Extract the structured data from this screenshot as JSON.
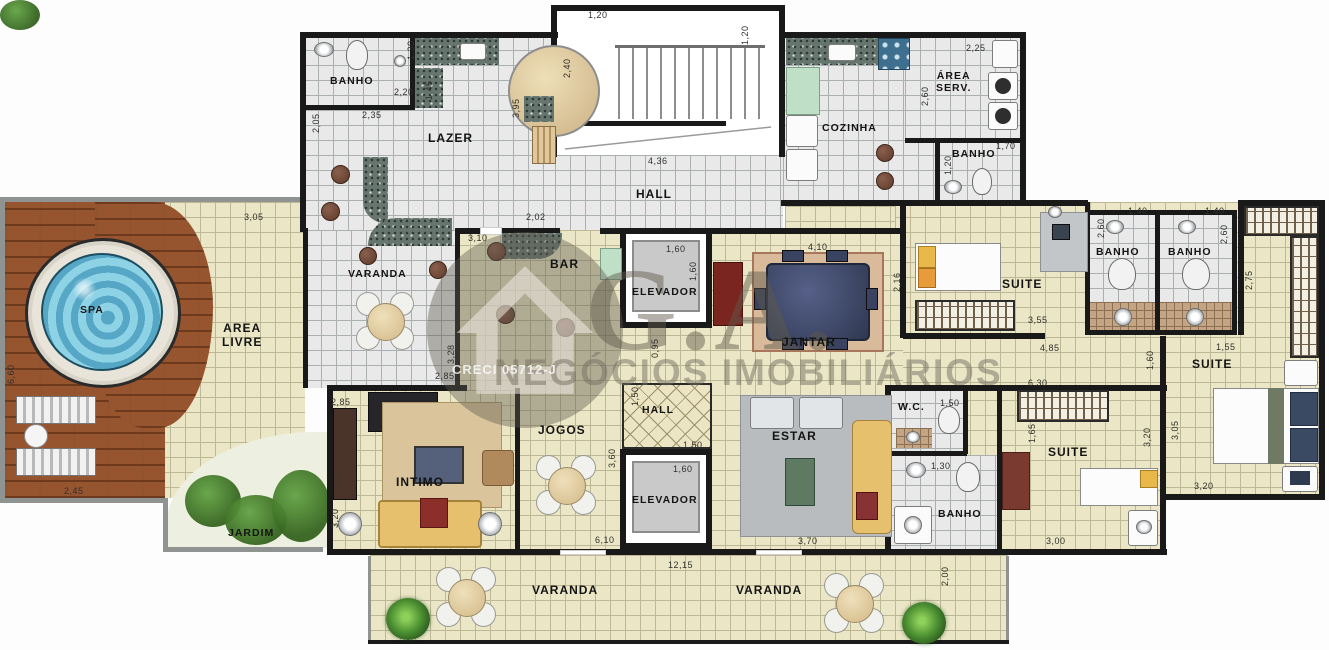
{
  "plan": {
    "title": "Planta baixa - pavimento",
    "watermark": {
      "brand": "G.A.",
      "subtitle": "NEGÓCIOS IMOBILIÁRIOS",
      "license": "CRECI 05712-J"
    },
    "colors": {
      "wall": "#191919",
      "floor_beige": "#ebe7c6",
      "floor_gray": "#e9e9e9",
      "deck_wood": "#96542f",
      "spa_water": "#72bdd8",
      "garden_green": "#3f7a33",
      "granite": "#66756e"
    },
    "room_labels": [
      {
        "id": "banho-lazer",
        "text": "BANHO",
        "x": 330,
        "y": 75,
        "small": true
      },
      {
        "id": "lazer",
        "text": "LAZER",
        "x": 428,
        "y": 132
      },
      {
        "id": "hall-top",
        "text": "HALL",
        "x": 636,
        "y": 188
      },
      {
        "id": "cozinha",
        "text": "COZINHA",
        "x": 822,
        "y": 122,
        "small": true
      },
      {
        "id": "area-serv",
        "text": "ÁREA\nSERV.",
        "x": 936,
        "y": 70,
        "small": true
      },
      {
        "id": "banho-serv",
        "text": "BANHO",
        "x": 952,
        "y": 148,
        "small": true
      },
      {
        "id": "varanda-mid",
        "text": "VARANDA",
        "x": 348,
        "y": 268,
        "small": true
      },
      {
        "id": "bar",
        "text": "BAR",
        "x": 550,
        "y": 258
      },
      {
        "id": "elevador-1",
        "text": "ELEVADOR",
        "x": 632,
        "y": 286,
        "small": true
      },
      {
        "id": "jantar",
        "text": "JANTAR",
        "x": 782,
        "y": 336
      },
      {
        "id": "suite-1",
        "text": "SUITE",
        "x": 1002,
        "y": 278
      },
      {
        "id": "banho-a",
        "text": "BANHO",
        "x": 1096,
        "y": 246,
        "small": true
      },
      {
        "id": "banho-b",
        "text": "BANHO",
        "x": 1168,
        "y": 246,
        "small": true
      },
      {
        "id": "area-livre",
        "text": "AREA\nLIVRE",
        "x": 222,
        "y": 322
      },
      {
        "id": "spa",
        "text": "SPA",
        "x": 80,
        "y": 304,
        "small": true
      },
      {
        "id": "intimo",
        "text": "INTIMO",
        "x": 396,
        "y": 476
      },
      {
        "id": "jogos",
        "text": "JOGOS",
        "x": 538,
        "y": 424
      },
      {
        "id": "hall-small",
        "text": "HALL",
        "x": 642,
        "y": 404,
        "small": true
      },
      {
        "id": "elevador-2",
        "text": "ELEVADOR",
        "x": 632,
        "y": 494,
        "small": true
      },
      {
        "id": "estar",
        "text": "ESTAR",
        "x": 772,
        "y": 430
      },
      {
        "id": "wc",
        "text": "W.C.",
        "x": 898,
        "y": 401,
        "small": true
      },
      {
        "id": "banho-3",
        "text": "BANHO",
        "x": 938,
        "y": 508,
        "small": true
      },
      {
        "id": "suite-3",
        "text": "SUITE",
        "x": 1048,
        "y": 446
      },
      {
        "id": "suite-2",
        "text": "SUITE",
        "x": 1192,
        "y": 358
      },
      {
        "id": "jardim",
        "text": "JARDIM",
        "x": 228,
        "y": 527,
        "small": true
      },
      {
        "id": "varanda-b1",
        "text": "VARANDA",
        "x": 532,
        "y": 584
      },
      {
        "id": "varanda-b2",
        "text": "VARANDA",
        "x": 736,
        "y": 584
      }
    ],
    "dim_labels": [
      {
        "text": "1,20",
        "x": 588,
        "y": 10
      },
      {
        "text": "1,20",
        "x": 740,
        "y": 45,
        "rot": true
      },
      {
        "text": "2,40",
        "x": 562,
        "y": 78,
        "rot": true
      },
      {
        "text": "4,36",
        "x": 648,
        "y": 156
      },
      {
        "text": "2,02",
        "x": 526,
        "y": 212
      },
      {
        "text": "1,30",
        "x": 406,
        "y": 60,
        "rot": true
      },
      {
        "text": "2,20",
        "x": 394,
        "y": 87
      },
      {
        "text": "2,35",
        "x": 362,
        "y": 110
      },
      {
        "text": "2,05",
        "x": 311,
        "y": 133,
        "rot": true
      },
      {
        "text": "1,45",
        "x": 424,
        "y": 100,
        "rot": true
      },
      {
        "text": "3,95",
        "x": 511,
        "y": 118,
        "rot": true
      },
      {
        "text": "2,25",
        "x": 966,
        "y": 43
      },
      {
        "text": "2,60",
        "x": 920,
        "y": 106,
        "rot": true
      },
      {
        "text": "1,70",
        "x": 996,
        "y": 141
      },
      {
        "text": "1,20",
        "x": 943,
        "y": 175,
        "rot": true
      },
      {
        "text": "1,40",
        "x": 1128,
        "y": 206
      },
      {
        "text": "1,40",
        "x": 1205,
        "y": 206
      },
      {
        "text": "2,60",
        "x": 1096,
        "y": 238,
        "rot": true
      },
      {
        "text": "2,60",
        "x": 1219,
        "y": 244,
        "rot": true
      },
      {
        "text": "2,75",
        "x": 1244,
        "y": 290,
        "rot": true
      },
      {
        "text": "3,05",
        "x": 244,
        "y": 212
      },
      {
        "text": "6,60",
        "x": 6,
        "y": 384,
        "rot": true
      },
      {
        "text": "2,45",
        "x": 64,
        "y": 486
      },
      {
        "text": "3,10",
        "x": 468,
        "y": 233
      },
      {
        "text": "2,85",
        "x": 435,
        "y": 371
      },
      {
        "text": "3,28",
        "x": 446,
        "y": 364,
        "rot": true
      },
      {
        "text": "1,60",
        "x": 666,
        "y": 244
      },
      {
        "text": "1,60",
        "x": 688,
        "y": 281,
        "rot": true
      },
      {
        "text": "4,10",
        "x": 808,
        "y": 242
      },
      {
        "text": "2,16",
        "x": 892,
        "y": 292,
        "rot": true
      },
      {
        "text": "0,95",
        "x": 650,
        "y": 358,
        "rot": true
      },
      {
        "text": "3,55",
        "x": 1028,
        "y": 315
      },
      {
        "text": "4,85",
        "x": 1040,
        "y": 343
      },
      {
        "text": "6,30",
        "x": 1028,
        "y": 378
      },
      {
        "text": "1,55",
        "x": 1216,
        "y": 342
      },
      {
        "text": "1,60",
        "x": 1145,
        "y": 370,
        "rot": true
      },
      {
        "text": "2,85",
        "x": 331,
        "y": 397
      },
      {
        "text": "3,20",
        "x": 330,
        "y": 528,
        "rot": true
      },
      {
        "text": "1,50",
        "x": 630,
        "y": 406,
        "rot": true
      },
      {
        "text": "1,50",
        "x": 683,
        "y": 440
      },
      {
        "text": "1,60",
        "x": 673,
        "y": 464
      },
      {
        "text": "3,60",
        "x": 607,
        "y": 468,
        "rot": true
      },
      {
        "text": "6,10",
        "x": 595,
        "y": 535
      },
      {
        "text": "3,70",
        "x": 798,
        "y": 536
      },
      {
        "text": "1,50",
        "x": 940,
        "y": 398
      },
      {
        "text": "1,30",
        "x": 931,
        "y": 461
      },
      {
        "text": "1,65",
        "x": 1027,
        "y": 443,
        "rot": true
      },
      {
        "text": "3,00",
        "x": 1046,
        "y": 536
      },
      {
        "text": "12,15",
        "x": 668,
        "y": 560
      },
      {
        "text": "2,00",
        "x": 940,
        "y": 586,
        "rot": true
      },
      {
        "text": "3,20",
        "x": 1142,
        "y": 447,
        "rot": true
      },
      {
        "text": "3,05",
        "x": 1170,
        "y": 440,
        "rot": true
      },
      {
        "text": "3,20",
        "x": 1194,
        "y": 481
      }
    ]
  }
}
